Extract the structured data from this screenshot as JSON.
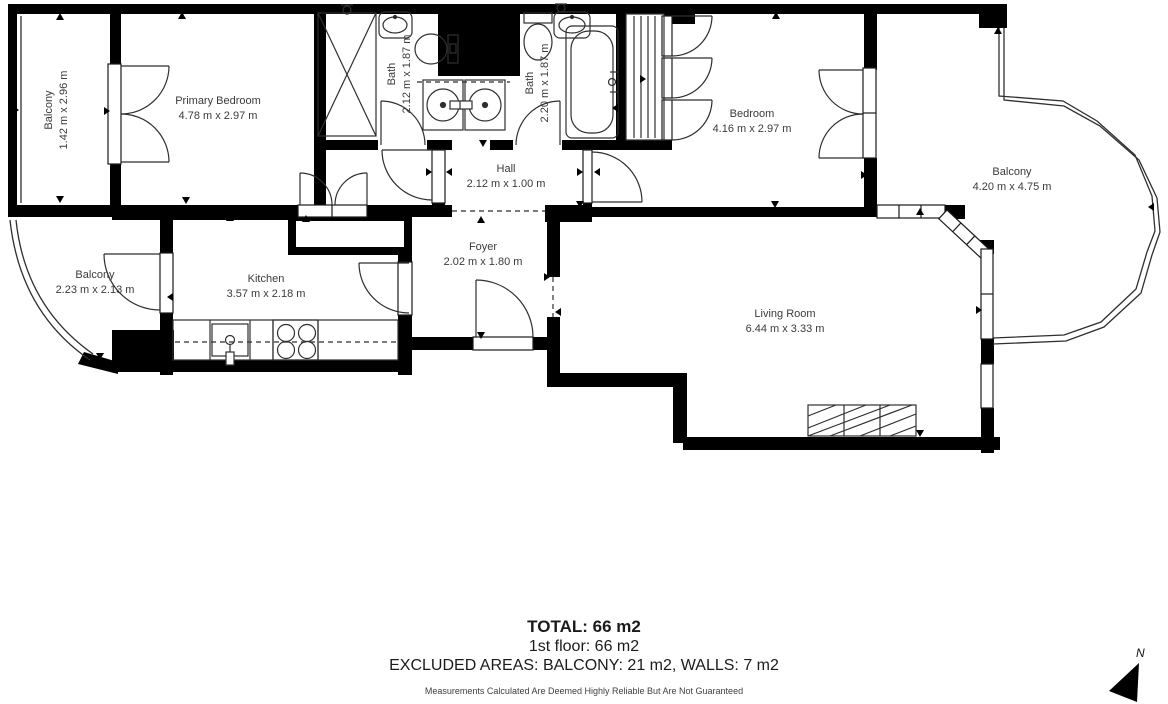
{
  "plan": {
    "rooms": [
      {
        "id": "balcony-top-left",
        "name": "Balcony",
        "dims": "1.42 m x 2.96 m"
      },
      {
        "id": "primary-bedroom",
        "name": "Primary Bedroom",
        "dims": "4.78 m x 2.97 m"
      },
      {
        "id": "bath-1",
        "name": "Bath",
        "dims": "2.12 m x 1.87 m"
      },
      {
        "id": "bath-2",
        "name": "Bath",
        "dims": "2.20 m x 1.87 m"
      },
      {
        "id": "hall",
        "name": "Hall",
        "dims": "2.12 m x 1.00 m"
      },
      {
        "id": "bedroom",
        "name": "Bedroom",
        "dims": "4.16 m x 2.97 m"
      },
      {
        "id": "balcony-right",
        "name": "Balcony",
        "dims": "4.20 m x 4.75 m"
      },
      {
        "id": "balcony-bottom-left",
        "name": "Balcony",
        "dims": "2.23 m x 2.13 m"
      },
      {
        "id": "kitchen",
        "name": "Kitchen",
        "dims": "3.57 m x 2.18 m"
      },
      {
        "id": "foyer",
        "name": "Foyer",
        "dims": "2.02 m x 1.80 m"
      },
      {
        "id": "living-room",
        "name": "Living Room",
        "dims": "6.44 m x 3.33 m"
      }
    ]
  },
  "footer": {
    "total": "TOTAL: 66 m2",
    "floor": "1st floor: 66 m2",
    "excluded": "EXCLUDED AREAS: BALCONY: 21 m2, WALLS: 7 m2",
    "disclaimer": "Measurements Calculated Are Deemed Highly Reliable But Are Not Guaranteed"
  },
  "compass": {
    "north_label": "N"
  },
  "colors": {
    "wall": "#000000",
    "line": "#2f2f2f",
    "text": "#3b3b3b"
  }
}
